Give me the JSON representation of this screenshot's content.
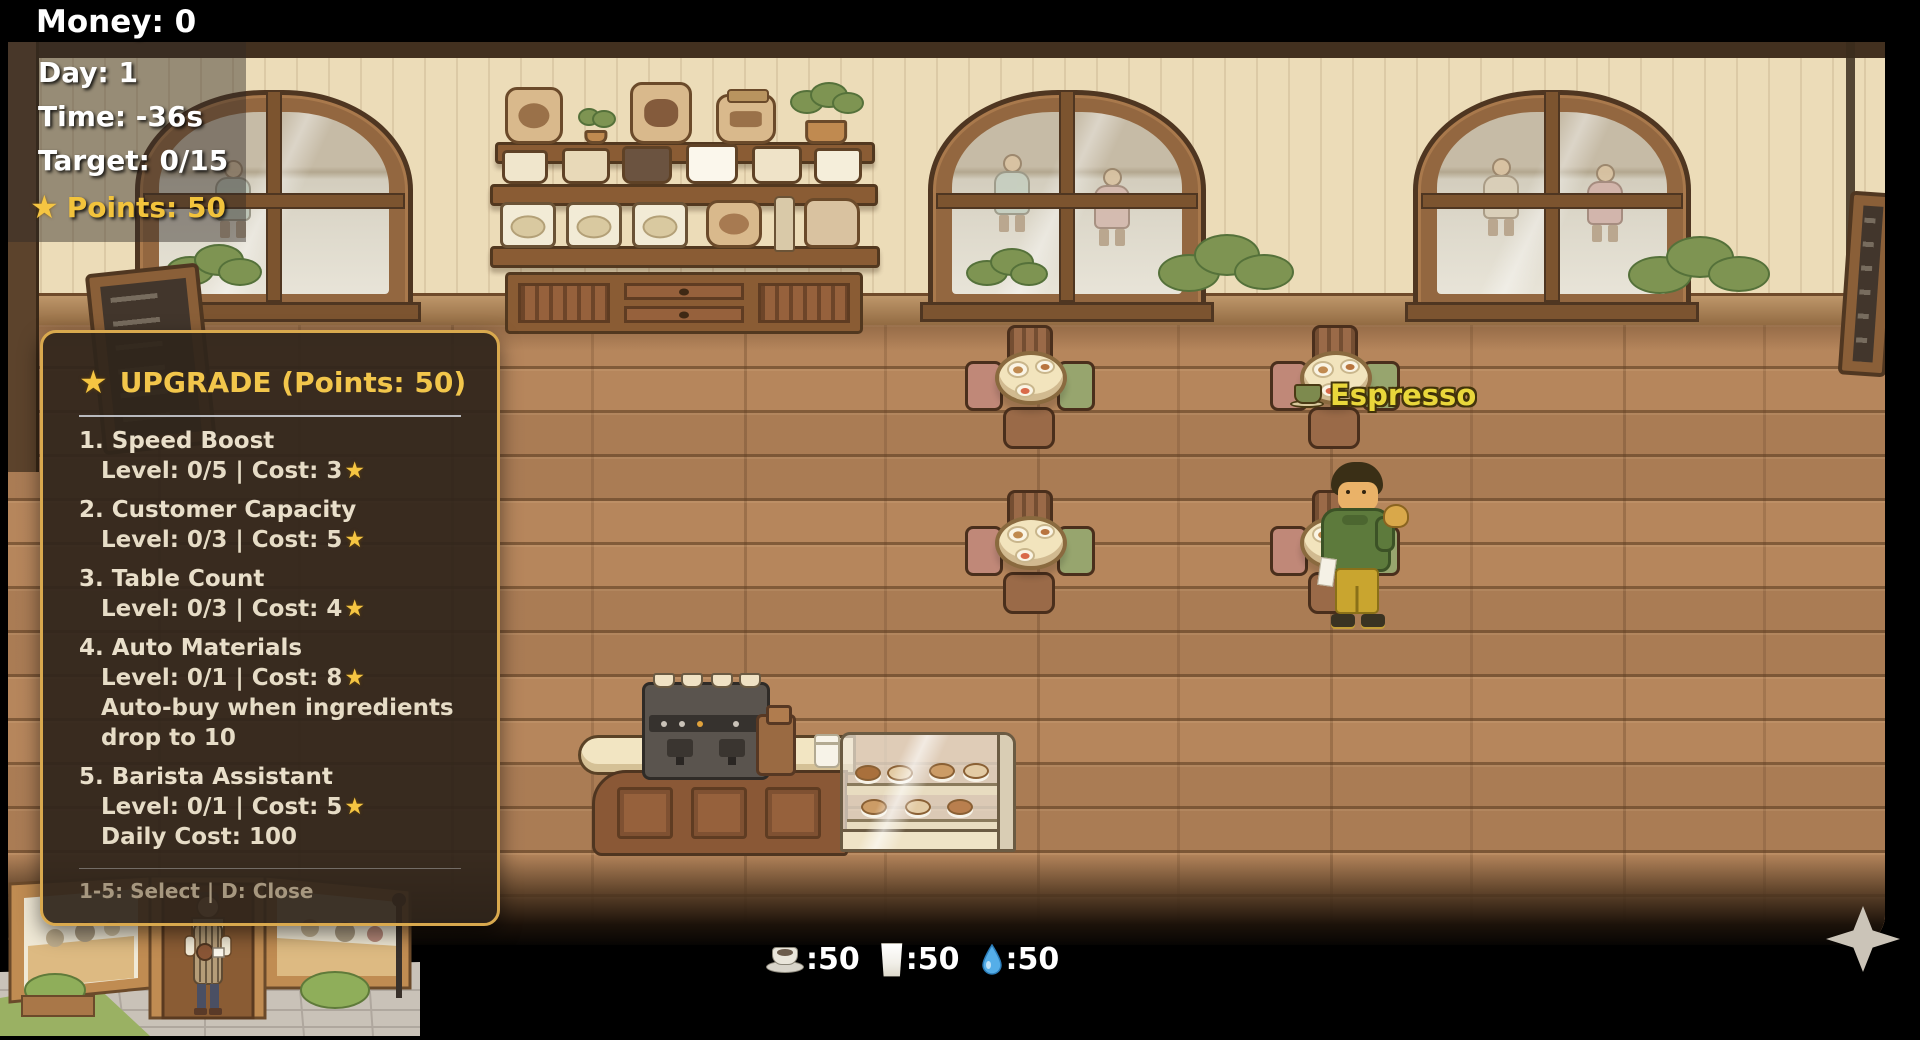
{
  "colors": {
    "accent_gold": "#f2c33c",
    "panel_border": "#d9a94e",
    "panel_bg": "rgba(47,37,27,0.93)",
    "order_yellow": "#e9d73b"
  },
  "icons": {
    "star": "★"
  },
  "hud": {
    "money": "Money: 0",
    "day": "Day: 1",
    "time": "Time: -36s",
    "target": "Target: 0/15",
    "points": "Points: 50"
  },
  "upgrade_panel": {
    "title": "UPGRADE (Points: 50)",
    "items": [
      {
        "name": "1. Speed Boost",
        "detail": "Level: 0/5 | Cost: 3"
      },
      {
        "name": "2. Customer Capacity",
        "detail": "Level: 0/3 | Cost: 5"
      },
      {
        "name": "3. Table Count",
        "detail": "Level: 0/3 | Cost: 4"
      },
      {
        "name": "4. Auto Materials",
        "detail": "Level: 0/1 | Cost: 8",
        "note": "Auto-buy when ingredients drop to 10"
      },
      {
        "name": "5. Barista Assistant",
        "detail": "Level: 0/1 | Cost: 5",
        "note": "Daily Cost: 100"
      }
    ],
    "footer": "1-5: Select | D: Close"
  },
  "order_bubble": {
    "label": "Espresso"
  },
  "resource_bar": [
    {
      "icon": "coffee-cup-icon",
      "label": ":50"
    },
    {
      "icon": "milk-glass-icon",
      "label": ":50"
    },
    {
      "icon": "water-drop-icon",
      "label": ":50"
    }
  ]
}
